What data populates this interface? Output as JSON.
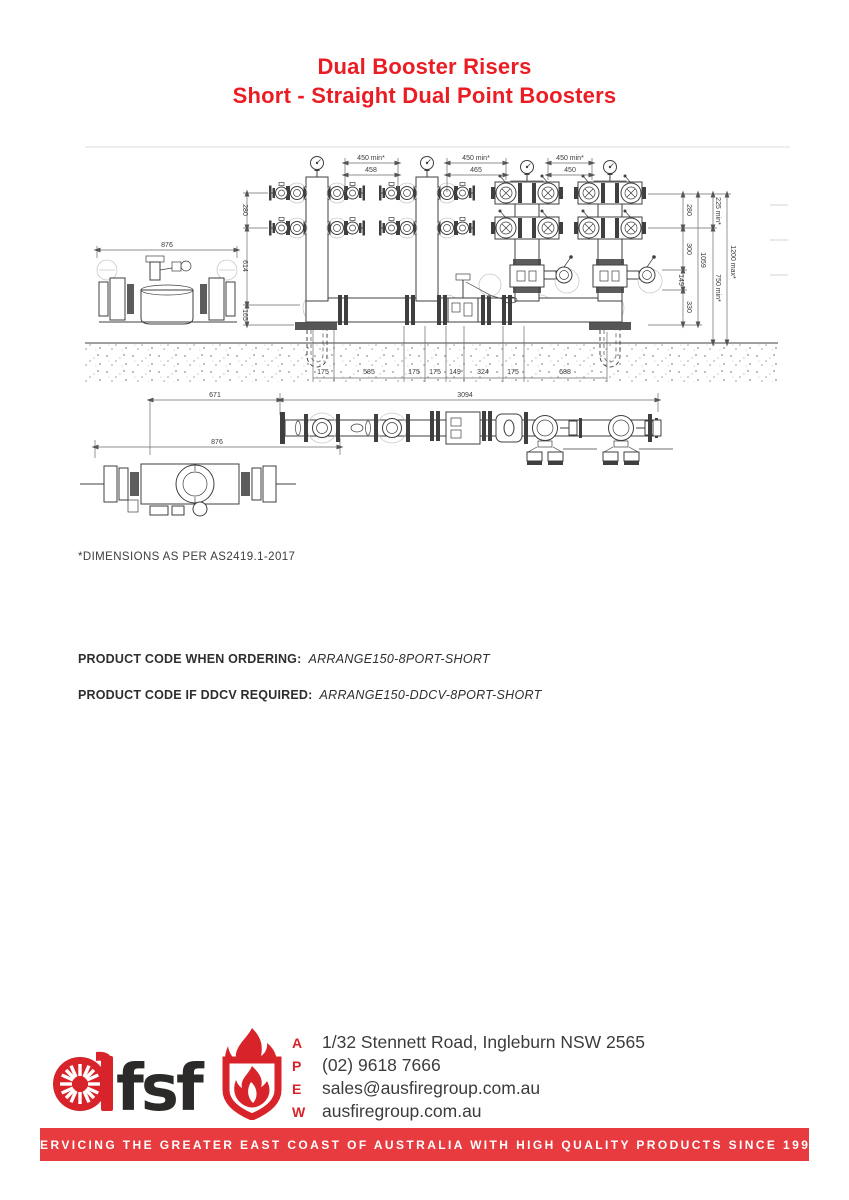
{
  "page": {
    "title1": "Dual Booster Risers",
    "title2": "Short - Straight Dual Point Boosters"
  },
  "drawing": {
    "note": "*DIMENSIONS AS PER AS2419.1-2017",
    "top_dims": [
      {
        "min": "450 min*",
        "val": "458"
      },
      {
        "min": "450 min*",
        "val": "465"
      },
      {
        "min": "450 min*",
        "val": "450"
      }
    ],
    "left_dims": [
      "280",
      "614",
      "165"
    ],
    "right_chain": [
      "280",
      "300",
      "149",
      "330"
    ],
    "right_outer": {
      "h1059": "1059",
      "min225": "225 min*",
      "min750": "750 min*",
      "max1200": "1200 max*"
    },
    "bottom_chain": [
      "175",
      "585",
      "175",
      "175",
      "149",
      "324",
      "175",
      "688"
    ],
    "overall": "3094",
    "plan_len": "671",
    "detail_side_width": "876",
    "detail_plan_width": "876"
  },
  "ordering": {
    "label1": "PRODUCT CODE WHEN ORDERING:",
    "code1": "ARRANGE150-8PORT-SHORT",
    "label2": "PRODUCT CODE IF DDCV REQUIRED:",
    "code2": "ARRANGE150-DDCV-8PORT-SHORT"
  },
  "footer": {
    "logo_text": "fsf",
    "contact": [
      {
        "k": "A",
        "v": "1/32 Stennett Road, Ingleburn NSW 2565"
      },
      {
        "k": "P",
        "v": "(02) 9618 7666"
      },
      {
        "k": "E",
        "v": "sales@ausfiregroup.com.au"
      },
      {
        "k": "W",
        "v": "ausfiregroup.com.au"
      }
    ],
    "banner": "SERVICING THE GREATER EAST COAST OF AUSTRALIA WITH HIGH QUALITY PRODUCTS SINCE 1995"
  },
  "colors": {
    "title_red": "#ea1d25",
    "brand_red": "#d8232a",
    "banner_red": "#e73b40",
    "ink": "#3c3c3b",
    "drawing_line": "#3f3f3f"
  }
}
